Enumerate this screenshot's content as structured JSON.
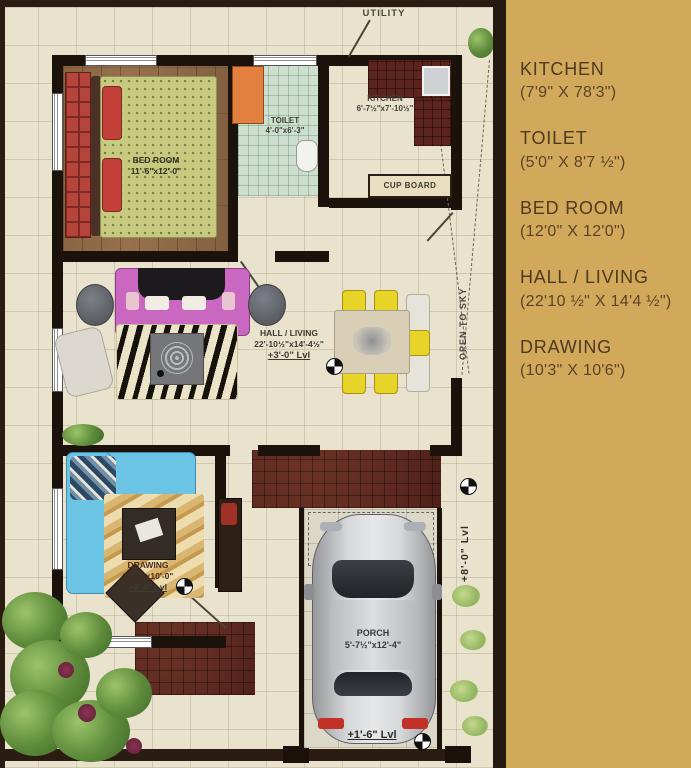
{
  "sidebar": {
    "items": [
      {
        "name": "KITCHEN",
        "dims": "(7'9\" X 78'3\")"
      },
      {
        "name": "TOILET",
        "dims": "(5'0\" X 8'7 ½\")"
      },
      {
        "name": "BED ROOM",
        "dims": "(12'0\" X 12'0\")"
      },
      {
        "name": "HALL / LIVING",
        "dims": "(22'10 ½\" X 14'4 ½\")"
      },
      {
        "name": "DRAWING",
        "dims": "(10'3\" X 10'6\")"
      }
    ]
  },
  "plan": {
    "bedroom_label": "BED ROOM",
    "bedroom_dims": "11'-6\"x12'-0\"",
    "toilet_label": "TOILET",
    "toilet_dims": "4'-0\"x6'-3\"",
    "kitchen_label": "KITCHEN",
    "kitchen_dims": "6'-7½\"x7'-10½\"",
    "hall_label": "HALL / LIVING",
    "hall_dims": "22'-10½\"x14'-4½\"",
    "hall_level": "+3'-0\" Lvl",
    "drawing_label": "DRAWING",
    "drawing_dims": "10'-3\"x10'-0\"",
    "drawing_level": "+2'-6\" Lvl",
    "porch_label": "PORCH",
    "porch_dims": "5'-7½\"x12'-4\"",
    "utility": "UTILITY",
    "cupboard": "CUP BOARD",
    "open_to_sky": "OPEN TO SKY",
    "level_side": "+8'-0\" Lvl",
    "level_entry": "+1'-6\" Lvl"
  },
  "colors": {
    "sidebar_bg": "#d2a85b",
    "wall": "#1b130b",
    "hall_sofa": "#c967c1",
    "drawing_sofa": "#6cc4e4",
    "dining_chair": "#e8d428",
    "brick_paving": "#5e2a20"
  }
}
